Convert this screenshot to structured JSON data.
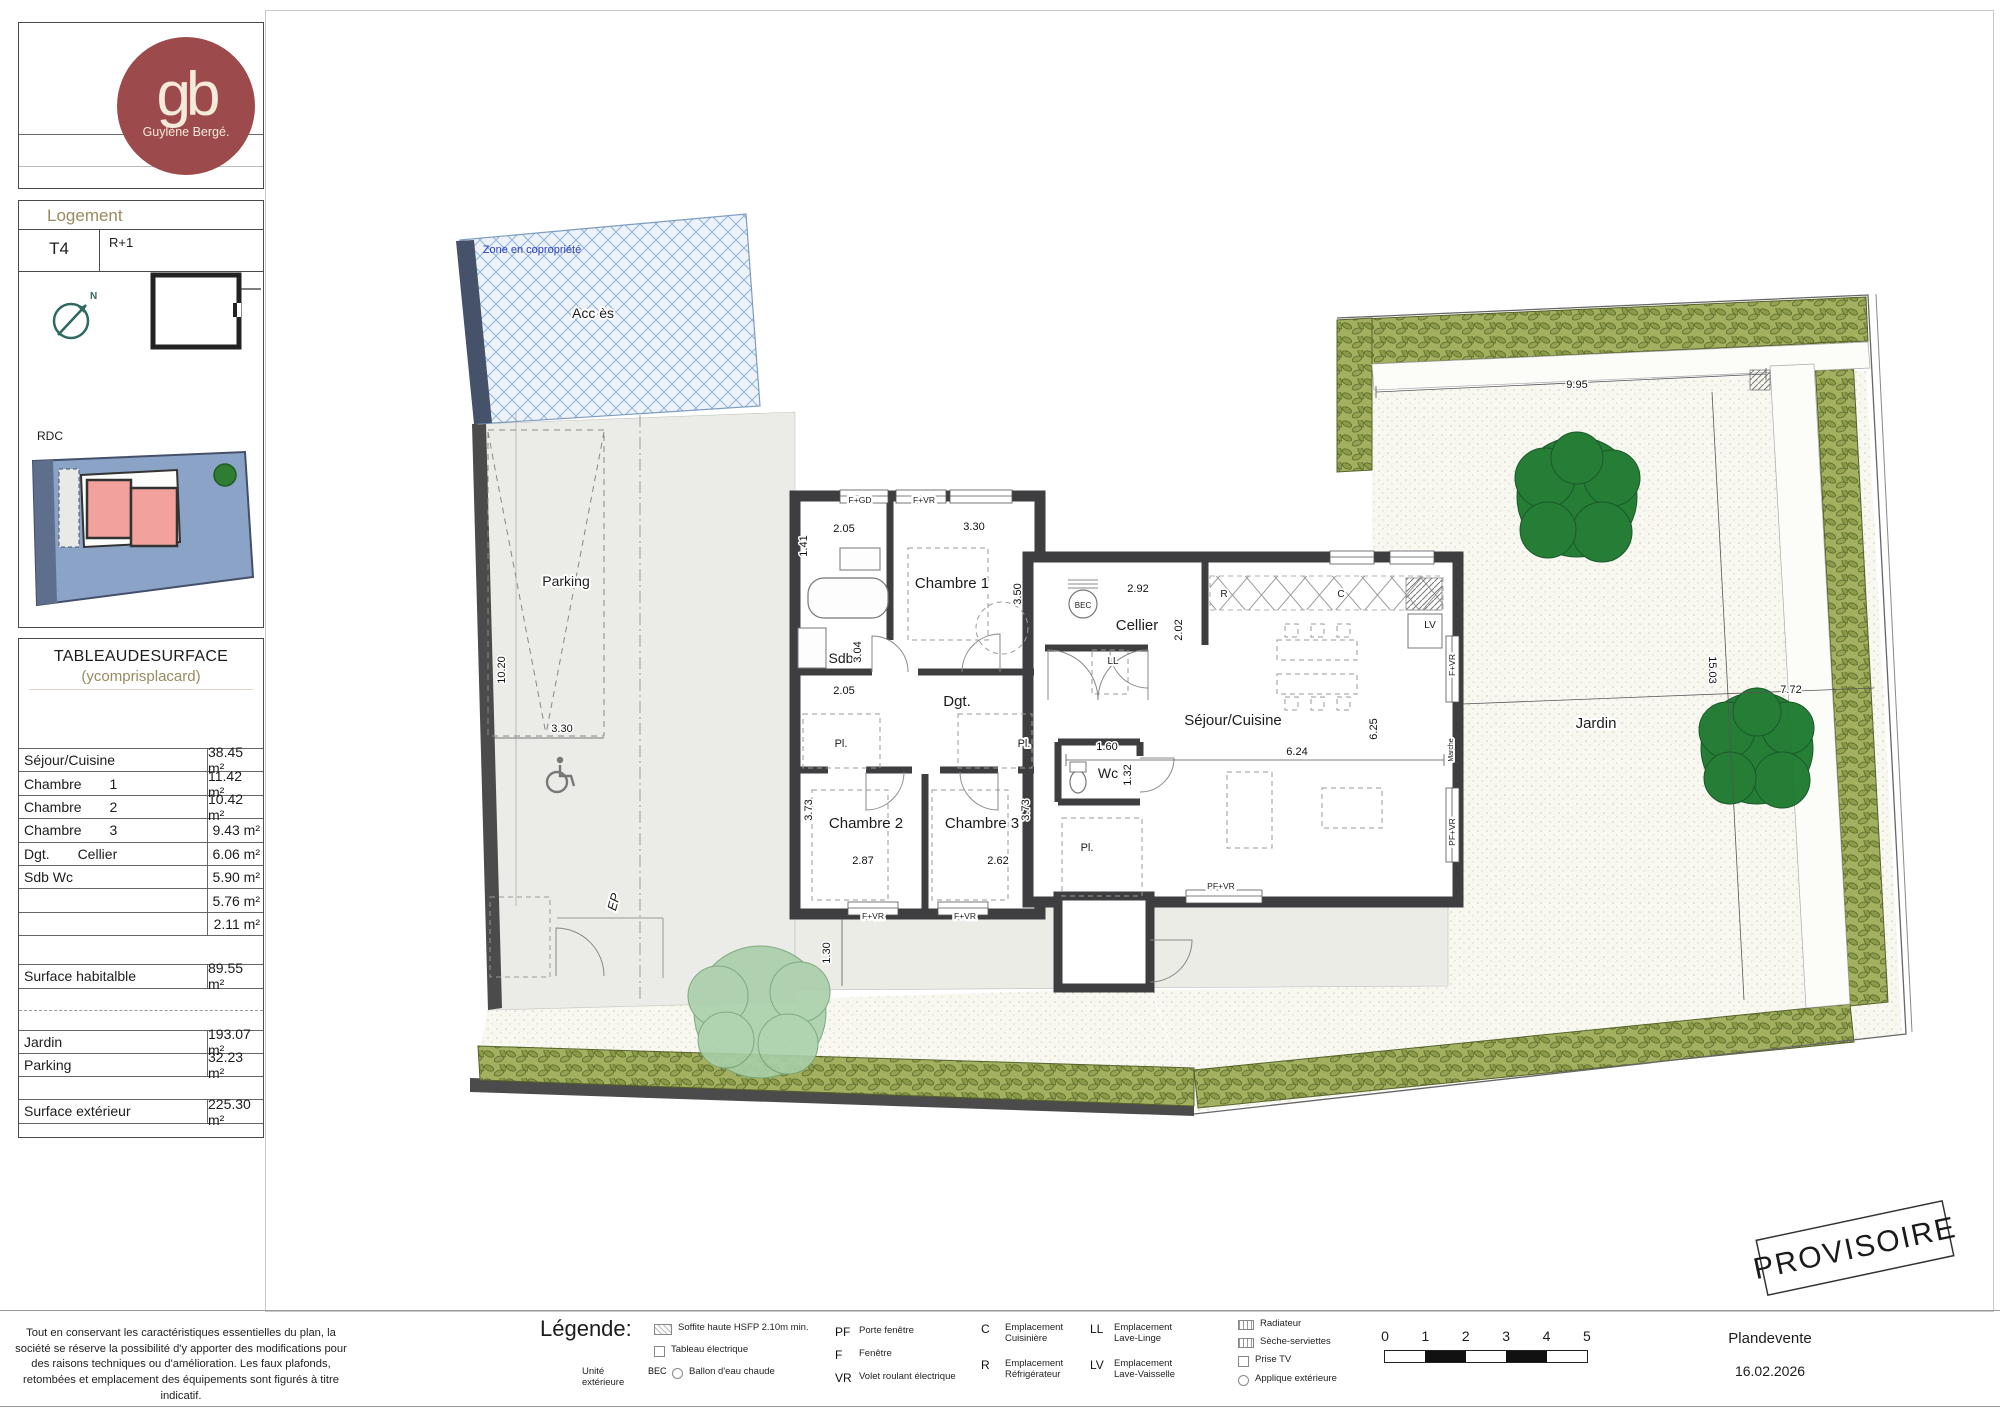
{
  "colors": {
    "logo-red": "#9d4a4c",
    "tan": "#998a60",
    "wall": "#3e3e40",
    "hedge": "#9aa85c",
    "tree": "#1e7a2f",
    "zone-blue": "#2b3fbf",
    "mini-blue": "#8aa3c6",
    "mini-pink": "#f2a19c"
  },
  "sidebar": {
    "logo": {
      "monogram": "gb",
      "brand": "Guylène Bergé."
    },
    "logement": {
      "title": "Logement",
      "type_label": "T4",
      "floor_label": "R+1",
      "rdc_label": "RDC",
      "north": "N"
    },
    "surface_table": {
      "title": "TABLEAUDESURFACE",
      "subtitle": "(ycomprisplacard)",
      "rows": [
        {
          "label": "Séjour/Cuisine",
          "value": "38.45 m²"
        },
        {
          "label": "Chambre 1",
          "value": "11.42 m²"
        },
        {
          "label": "Chambre 2",
          "value": "10.42 m²"
        },
        {
          "label": "Chambre 3",
          "value": "9.43 m²"
        },
        {
          "label": "Dgt. Cellier",
          "value": "6.06 m²"
        },
        {
          "label": "Sdb Wc",
          "value": "5.90 m²"
        },
        {
          "label": "",
          "value": "5.76 m²"
        },
        {
          "label": "",
          "value": "2.11 m²"
        }
      ],
      "habitable": {
        "label": "Surface habitalble",
        "value": "89.55 m²"
      },
      "exterior_rows": [
        {
          "label": "Jardin",
          "value": "193.07 m²"
        },
        {
          "label": "Parking",
          "value": "32.23 m²"
        }
      ],
      "exterior_total": {
        "label": "Surface extérieur",
        "value": "225.30 m²"
      }
    }
  },
  "plan": {
    "stamp": "PROVISOIRE",
    "labels": [
      {
        "t": "Chambre 1",
        "x": 952,
        "y": 588,
        "n": "room-label-chambre-1"
      },
      {
        "t": "Chambre 2",
        "x": 866,
        "y": 828,
        "n": "room-label-chambre-2"
      },
      {
        "t": "Chambre 3",
        "x": 982,
        "y": 828,
        "n": "room-label-chambre-3"
      },
      {
        "t": "Sdb",
        "x": 841,
        "y": 663,
        "s": 14,
        "n": "room-label-sdb"
      },
      {
        "t": "Dgt.",
        "x": 957,
        "y": 706,
        "n": "room-label-dgt"
      },
      {
        "t": "Cellier",
        "x": 1137,
        "y": 630,
        "n": "room-label-cellier"
      },
      {
        "t": "Wc",
        "x": 1108,
        "y": 778,
        "s": 14,
        "n": "room-label-wc"
      },
      {
        "t": "Séjour/Cuisine",
        "x": 1233,
        "y": 725,
        "n": "room-label-sejour-cuisine"
      },
      {
        "t": "Jardin",
        "x": 1596,
        "y": 728,
        "n": "area-label-jardin"
      },
      {
        "t": "Parking",
        "x": 566,
        "y": 586,
        "s": 14,
        "n": "area-label-parking"
      },
      {
        "t": "Acc ès",
        "x": 593,
        "y": 318,
        "s": 14,
        "n": "area-label-acces"
      },
      {
        "t": "Zone en copropriété",
        "x": 532,
        "y": 253,
        "s": 11,
        "col": "#2b3fbf",
        "c": "zone",
        "n": "zone-copropriete-label"
      },
      {
        "t": "Pl.",
        "x": 841,
        "y": 747,
        "s": 11,
        "n": "closet-label"
      },
      {
        "t": "Pl.",
        "x": 1024,
        "y": 747,
        "s": 11,
        "n": "closet-label"
      },
      {
        "t": "Pl.",
        "x": 1087,
        "y": 851,
        "s": 11,
        "n": "closet-label"
      },
      {
        "t": "LL",
        "x": 1113,
        "y": 664,
        "s": 10,
        "n": "appliance-label-ll"
      },
      {
        "t": "LV",
        "x": 1430,
        "y": 628,
        "s": 10,
        "n": "appliance-label-lv"
      },
      {
        "t": "BEC",
        "x": 1083,
        "y": 608,
        "s": 8,
        "n": "appliance-label-bec"
      },
      {
        "t": "R",
        "x": 1224,
        "y": 597,
        "s": 10,
        "n": "appliance-label-r"
      },
      {
        "t": "C",
        "x": 1341,
        "y": 597,
        "s": 10,
        "n": "appliance-label-c"
      },
      {
        "t": "EP",
        "x": 618,
        "y": 903,
        "s": 13,
        "r": -75,
        "c": "ep",
        "n": "ep-label"
      },
      {
        "t": "Marche",
        "x": 1453,
        "y": 750,
        "s": 7,
        "r": -90,
        "n": "marche-label"
      },
      {
        "t": "F+GD",
        "x": 860,
        "y": 503,
        "c": "chip",
        "n": "window-label"
      },
      {
        "t": "F+VR",
        "x": 924,
        "y": 503,
        "c": "chip",
        "n": "window-label"
      },
      {
        "t": "F+VR",
        "x": 873,
        "y": 919,
        "c": "chip",
        "n": "window-label"
      },
      {
        "t": "F+VR",
        "x": 965,
        "y": 919,
        "c": "chip",
        "n": "window-label"
      },
      {
        "t": "PF+VR",
        "x": 1221,
        "y": 889,
        "c": "chip",
        "n": "window-label"
      },
      {
        "t": "F+VR",
        "x": 1455,
        "y": 665,
        "r": -90,
        "c": "chip",
        "n": "window-label"
      },
      {
        "t": "PF+VR",
        "x": 1455,
        "y": 832,
        "r": -90,
        "c": "chip",
        "n": "window-label"
      },
      {
        "t": "2.05",
        "x": 844,
        "y": 532,
        "c": "dim",
        "n": "dim-label"
      },
      {
        "t": "1.41",
        "x": 807,
        "y": 546,
        "r": -90,
        "c": "dim",
        "n": "dim-label"
      },
      {
        "t": "3.30",
        "x": 974,
        "y": 530,
        "c": "dim",
        "n": "dim-label"
      },
      {
        "t": "3.50",
        "x": 1021,
        "y": 594,
        "r": -90,
        "c": "dim",
        "n": "dim-label"
      },
      {
        "t": "2.92",
        "x": 1138,
        "y": 592,
        "c": "dim",
        "n": "dim-label"
      },
      {
        "t": "2.02",
        "x": 1182,
        "y": 630,
        "r": -90,
        "c": "dim",
        "n": "dim-label"
      },
      {
        "t": "3.04",
        "x": 861,
        "y": 652,
        "r": -90,
        "c": "dim",
        "n": "dim-label"
      },
      {
        "t": "2.05",
        "x": 844,
        "y": 694,
        "c": "dim",
        "n": "dim-label"
      },
      {
        "t": "1.60",
        "x": 1107,
        "y": 750,
        "c": "dim",
        "n": "dim-label"
      },
      {
        "t": "1.32",
        "x": 1131,
        "y": 775,
        "r": -90,
        "c": "dim",
        "n": "dim-label"
      },
      {
        "t": "3.73",
        "x": 812,
        "y": 810,
        "r": -90,
        "c": "dim",
        "n": "dim-label"
      },
      {
        "t": "3.73",
        "x": 1029,
        "y": 810,
        "r": -90,
        "c": "dim",
        "n": "dim-label"
      },
      {
        "t": "2.87",
        "x": 863,
        "y": 864,
        "c": "dim",
        "n": "dim-label"
      },
      {
        "t": "2.62",
        "x": 998,
        "y": 864,
        "c": "dim",
        "n": "dim-label"
      },
      {
        "t": "6.24",
        "x": 1297,
        "y": 755,
        "c": "dim",
        "n": "dim-label"
      },
      {
        "t": "6.25",
        "x": 1377,
        "y": 729,
        "r": -90,
        "c": "dim",
        "n": "dim-label"
      },
      {
        "t": "9.95",
        "x": 1577,
        "y": 388,
        "c": "dim",
        "n": "dim-label"
      },
      {
        "t": "15.03",
        "x": 1709,
        "y": 670,
        "r": 90,
        "c": "dim",
        "n": "dim-label"
      },
      {
        "t": "7.72",
        "x": 1791,
        "y": 693,
        "c": "dim",
        "n": "dim-label"
      },
      {
        "t": "10.20",
        "x": 505,
        "y": 670,
        "r": -90,
        "c": "dim",
        "n": "dim-label"
      },
      {
        "t": "3.30",
        "x": 562,
        "y": 732,
        "c": "dim",
        "n": "dim-label"
      },
      {
        "t": "1.30",
        "x": 830,
        "y": 953,
        "r": -90,
        "c": "dim",
        "n": "dim-label"
      }
    ]
  },
  "footer": {
    "disclaimer": "Tout en conservant les caractéristiques essentielles du plan, la société se réserve la possibilité d'y apporter des modifications pour des raisons techniques ou d'amélioration. Les faux plafonds, retombées et emplacement des équipements sont figurés à titre indicatif.",
    "legend": {
      "title": "Légende:",
      "col1": [
        {
          "pre": "",
          "sym": "",
          "text": "Soffite haute HSFP 2.10m min."
        },
        {
          "pre": "",
          "sym": "",
          "text": "Tableau électrique"
        },
        {
          "pre": "Unité extérieure",
          "sym": "BEC",
          "text": "Ballon d'eau chaude"
        }
      ],
      "col2": [
        {
          "sym": "PF",
          "text": "Porte fenêtre"
        },
        {
          "sym": "F",
          "text": "Fenêtre"
        },
        {
          "sym": "VR",
          "text": "Volet roulant électrique"
        }
      ],
      "col3": [
        {
          "sym": "C",
          "text": "Emplacement Cuisinière"
        },
        {
          "sym": "R",
          "text": "Emplacement Réfrigérateur"
        }
      ],
      "col4": [
        {
          "sym": "LL",
          "text": "Emplacement Lave-Linge"
        },
        {
          "sym": "LV",
          "text": "Emplacement Lave-Vaisselle"
        }
      ],
      "col5": [
        {
          "text": "Radiateur"
        },
        {
          "text": "Sèche-serviettes"
        },
        {
          "text": "Prise TV"
        },
        {
          "text": "Applique extérieure"
        }
      ]
    },
    "scale": {
      "ticks": [
        "0",
        "1",
        "2",
        "3",
        "4",
        "5"
      ]
    },
    "titleblock": {
      "doc": "Plandevente",
      "date": "16.02.2026"
    }
  }
}
